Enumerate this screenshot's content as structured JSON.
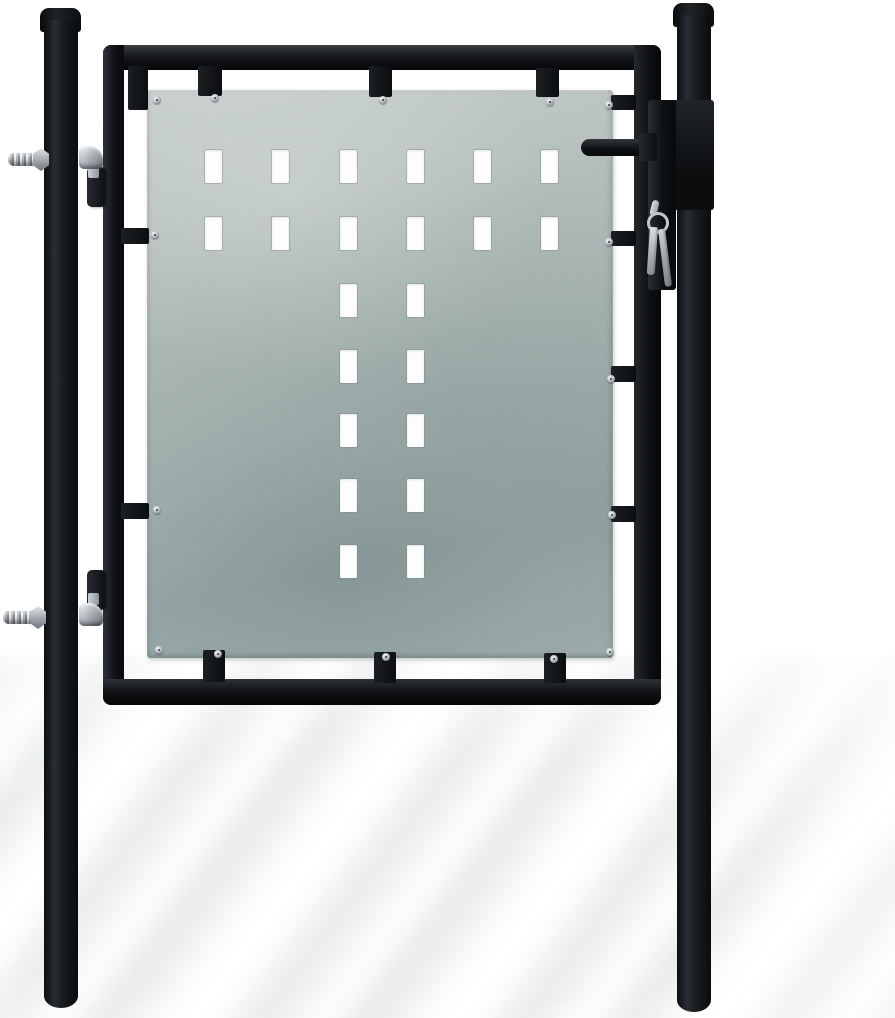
{
  "scene": {
    "type": "product-photo",
    "subject": "black single garden fence gate with galvanized perforated steel panel, two round posts, hinges and lock with hanging keys",
    "background": "#ffffff"
  },
  "colors": {
    "steel_black": "#0e1013",
    "steel_black_highlight": "#34383c",
    "panel_light": "#c7cfcc",
    "panel_base": "#9cabaa",
    "panel_dark": "#93a3a2",
    "hole_white": "#fdfdfd",
    "chrome_light": "#eceef0",
    "chrome_dark": "#878e94",
    "shadow_gray": "rgba(95,100,100,0.13)"
  },
  "layout": {
    "stage": [
      0,
      0,
      895,
      1018
    ],
    "ground_shadow": [
      -80,
      655,
      1060,
      400
    ],
    "left_post_cap": [
      40,
      8,
      41,
      24
    ],
    "left_post": [
      44,
      20,
      34,
      988
    ],
    "right_post_cap": [
      673,
      3,
      41,
      24
    ],
    "right_post": [
      677,
      15,
      34,
      997
    ],
    "frame_top": [
      103,
      45,
      558,
      25
    ],
    "frame_left": [
      103,
      45,
      21,
      660
    ],
    "frame_right": [
      634,
      45,
      27,
      660
    ],
    "frame_bottom": [
      103,
      679,
      558,
      26
    ],
    "panel": [
      147,
      90,
      466,
      568
    ]
  },
  "panel_pattern": {
    "hole_w": 17,
    "hole_h": 33,
    "hole_count": 22,
    "col_x": [
      58,
      125,
      193,
      260,
      327,
      394
    ],
    "row_y": [
      60,
      127,
      194,
      260,
      324,
      389,
      455
    ],
    "rows": [
      [
        0,
        1,
        2,
        3,
        4,
        5
      ],
      [
        0,
        1,
        2,
        3,
        4,
        5
      ],
      [
        2,
        3
      ],
      [
        2,
        3
      ],
      [
        2,
        3
      ],
      [
        2,
        3
      ],
      [
        2,
        3
      ]
    ]
  },
  "screws": [
    [
      153,
      96
    ],
    [
      211,
      94
    ],
    [
      379,
      96
    ],
    [
      546,
      98
    ],
    [
      605,
      101
    ],
    [
      151,
      231
    ],
    [
      153,
      506
    ],
    [
      155,
      646
    ],
    [
      605,
      238
    ],
    [
      607,
      375
    ],
    [
      608,
      511
    ],
    [
      606,
      648
    ],
    [
      214,
      650
    ],
    [
      382,
      653
    ],
    [
      550,
      655
    ]
  ],
  "tabs": [
    [
      198,
      66,
      24,
      30
    ],
    [
      369,
      66,
      23,
      31
    ],
    [
      536,
      68,
      23,
      29
    ],
    [
      128,
      66,
      20,
      44
    ],
    [
      203,
      650,
      22,
      32
    ],
    [
      374,
      652,
      22,
      31
    ],
    [
      544,
      653,
      22,
      30
    ],
    [
      121,
      228,
      28,
      16
    ],
    [
      121,
      503,
      28,
      16
    ],
    [
      611,
      95,
      25,
      15
    ],
    [
      611,
      231,
      25,
      15
    ],
    [
      611,
      366,
      25,
      16
    ],
    [
      611,
      506,
      25,
      16
    ]
  ],
  "hardware": {
    "top_hinge_rod": [
      8,
      153,
      40,
      13
    ],
    "top_hinge_nut": [
      33,
      148,
      16,
      23
    ],
    "top_hinge_elbow": [
      79,
      146,
      24,
      23
    ],
    "top_hinge_stem": [
      88,
      166,
      11,
      12
    ],
    "top_hinge_bracket": [
      87,
      167,
      19,
      40
    ],
    "bottom_hinge_rod": [
      3,
      611,
      42,
      13
    ],
    "bottom_hinge_nut": [
      30,
      606,
      16,
      23
    ],
    "bottom_hinge_elbow": [
      79,
      603,
      24,
      23
    ],
    "bottom_hinge_stem": [
      88,
      593,
      11,
      12
    ],
    "bottom_hinge_bracket": [
      87,
      570,
      19,
      40
    ],
    "latch_handle": [
      581,
      139,
      68,
      17
    ],
    "latch_hub": [
      639,
      133,
      18,
      28
    ],
    "lock_body": [
      648,
      100,
      28,
      190
    ],
    "lock_keeper": [
      664,
      100,
      50,
      110
    ],
    "key_shackle": [
      651,
      200,
      7,
      16
    ],
    "key_ring": [
      647,
      212,
      16,
      16
    ],
    "key_1": [
      650,
      227,
      8,
      48
    ],
    "key_2": [
      658,
      229,
      7,
      58
    ]
  }
}
